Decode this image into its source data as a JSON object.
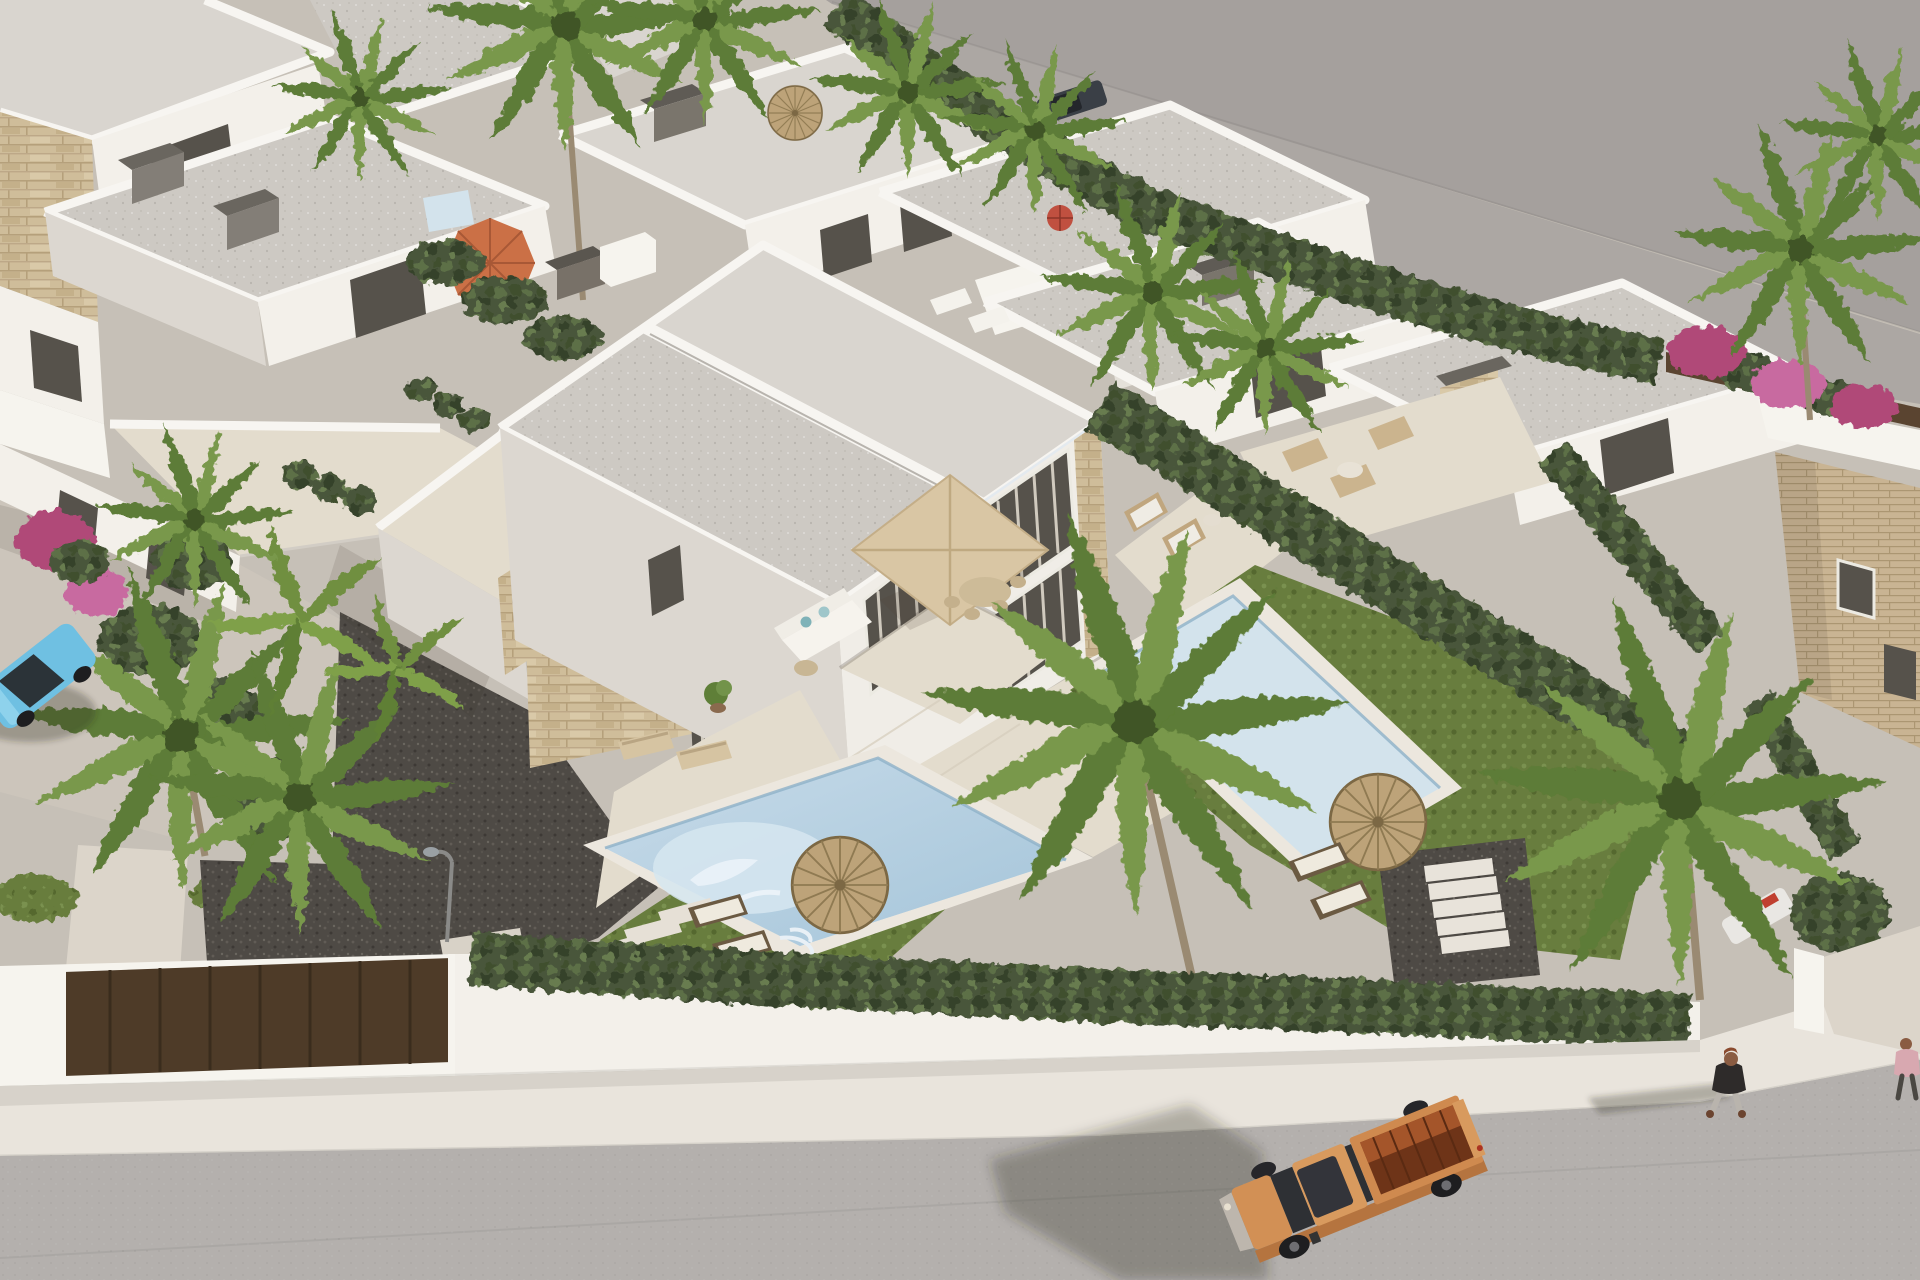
{
  "scene": {
    "type": "architectural-3d-render",
    "title": "Aerial 3D render of a modern white villa development with private pools, palm trees, hedged gardens and a street with an orange pickup truck",
    "description": "Bird's-eye visualization of semi-detached modern villas: flat gray roofs, white walls with travertine stone accents, two turquoise pools, beige and thatch parasols, cypress hedges, dark gravel yards, a perimeter white wall with a brown gate, a sidewalk and asphalt road with an orange pickup truck, a light blue parked car and pedestrians.",
    "colors": {
      "backdrop_wall": "#a5a09d",
      "backdrop_floor": "#aca7a3",
      "road": "#b4b0ad",
      "sidewalk": "#e9e4dc",
      "wall_white": "#f3f0ea",
      "wall_shadow": "#dcd7d0",
      "roof_gray": "#cdc9c3",
      "roof_light": "#d9d5cf",
      "parapet": "#f7f5f1",
      "stone": "#cfbd9a",
      "brick": "#c9b493",
      "hedge": "#49573a",
      "hedge_light": "#5d6f47",
      "grass": "#687d3e",
      "gravel": "#4e4a45",
      "concrete": "#ccc5bb",
      "walkway": "#dcd5ca",
      "terrace": "#e3dccd",
      "pool_water": "#b7d1e1",
      "pool_light": "#d3e3ec",
      "pool_coping": "#ece7de",
      "umbrella_orange": "#cb7046",
      "umbrella_beige": "#d9c6a4",
      "thatch": "#bda379",
      "thatch_dark": "#8f7a52",
      "truck_body": "#d29055",
      "truck_side": "#b5743f",
      "truck_bed": "#6e3418",
      "truck_bed_glow": "#a4552a",
      "glass_dark": "#2f3135",
      "window_dark": "#56524b",
      "curtain": "#ded7cb",
      "car_blue": "#6fc0e2",
      "suv_dark": "#3a3f46",
      "gate_brown": "#4e3b28",
      "fence_brown": "#5a4430",
      "bougainvillea": "#b04a78",
      "palm_green": "#5d7c37",
      "palm_light": "#79984c",
      "skin": "#8a5c42",
      "jacket": "#2e2b2a",
      "pants": "#b9b4ad",
      "shirt_pink": "#d8a8b0"
    },
    "objects": {
      "buildings": [
        {
          "label": "central semi-detached two-storey villa with flat roof, stone accents and curtained windows"
        },
        {
          "label": "left neighbouring villa with stone bands and roof terrace"
        },
        {
          "label": "row of white villas along the top with dark chimney caps"
        },
        {
          "label": "right row of villas with stone chimney"
        },
        {
          "label": "far-right stone-clad house"
        }
      ],
      "pools": [
        {
          "label": "central pool with mosaic bottom"
        },
        {
          "label": "right garden pool"
        },
        {
          "label": "small pool glimpse behind top hedge"
        }
      ],
      "umbrellas": [
        {
          "label": "beige square patio umbrella over dining set"
        },
        {
          "label": "orange parasol on upper-left terrace"
        },
        {
          "label": "small red parasol behind top hedge"
        },
        {
          "label": "thatch parasol in front garden"
        },
        {
          "label": "thatch parasol in right garden"
        }
      ],
      "vehicles": [
        {
          "label": "orange pickup truck driving on the road"
        },
        {
          "label": "light blue car parked at left edge"
        },
        {
          "label": "dark SUV behind top hedge"
        },
        {
          "label": "white car with red detail in right driveway"
        }
      ],
      "people": [
        {
          "label": "pedestrian in dark jacket walking on sidewalk"
        },
        {
          "label": "partial pedestrian in pink at right edge"
        }
      ],
      "furniture": [
        {
          "label": "white corner sofa with teal cushions"
        },
        {
          "label": "outdoor dining table with chairs"
        },
        {
          "label": "two wicker armchairs"
        },
        {
          "label": "pairs of sun loungers"
        },
        {
          "label": "neighbour terrace seating set"
        },
        {
          "label": "rooftop loungers"
        }
      ],
      "landscape": [
        {
          "label": "cypress hedges"
        },
        {
          "label": "palm trees"
        },
        {
          "label": "bougainvillea in bloom"
        },
        {
          "label": "lawns and dark gravel yards"
        },
        {
          "label": "white stepping-stone paths and garden steps"
        },
        {
          "label": "street lamp"
        },
        {
          "label": "white perimeter wall with brown gate"
        }
      ]
    }
  }
}
